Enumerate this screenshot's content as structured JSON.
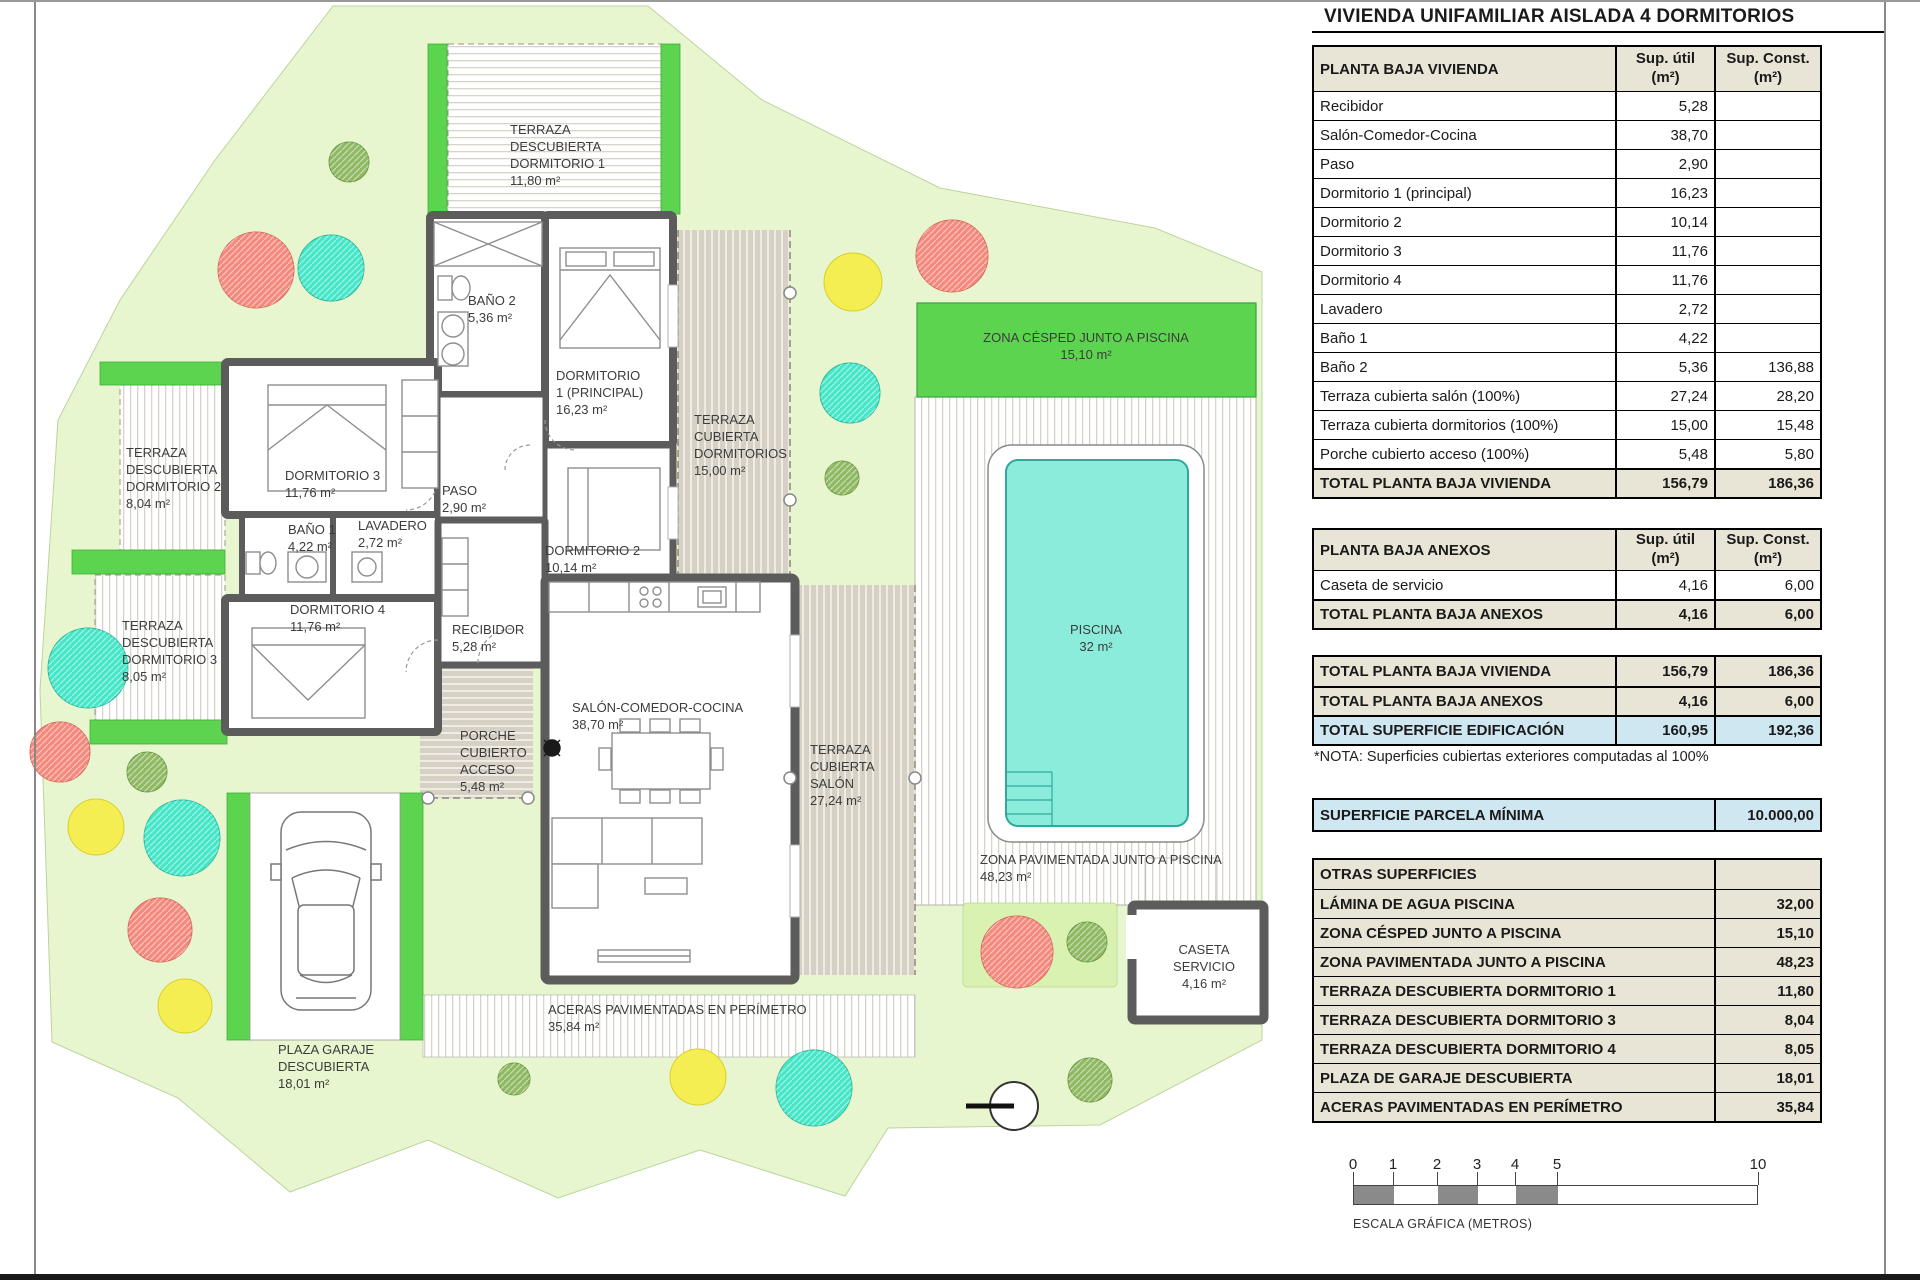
{
  "title": "VIVIENDA UNIFAMILIAR AISLADA 4 DORMITORIOS",
  "columns": {
    "util_lines": [
      "Sup. útil",
      "(m²)"
    ],
    "const_lines": [
      "Sup. Const.",
      "(m²)"
    ]
  },
  "vivienda": {
    "header": "PLANTA BAJA VIVIENDA",
    "rows": [
      {
        "label": "Recibidor",
        "util": "5,28",
        "const": ""
      },
      {
        "label": "Salón-Comedor-Cocina",
        "util": "38,70",
        "const": ""
      },
      {
        "label": "Paso",
        "util": "2,90",
        "const": ""
      },
      {
        "label": "Dormitorio 1 (principal)",
        "util": "16,23",
        "const": ""
      },
      {
        "label": "Dormitorio 2",
        "util": "10,14",
        "const": ""
      },
      {
        "label": "Dormitorio 3",
        "util": "11,76",
        "const": ""
      },
      {
        "label": "Dormitorio 4",
        "util": "11,76",
        "const": ""
      },
      {
        "label": "Lavadero",
        "util": "2,72",
        "const": ""
      },
      {
        "label": "Baño 1",
        "util": "4,22",
        "const": ""
      },
      {
        "label": "Baño 2",
        "util": "5,36",
        "const": "136,88"
      },
      {
        "label": "Terraza cubierta salón (100%)",
        "util": "27,24",
        "const": "28,20"
      },
      {
        "label": "Terraza cubierta dormitorios (100%)",
        "util": "15,00",
        "const": "15,48"
      },
      {
        "label": "Porche cubierto acceso (100%)",
        "util": "5,48",
        "const": "5,80"
      }
    ],
    "total": {
      "label": "TOTAL PLANTA BAJA VIVIENDA",
      "util": "156,79",
      "const": "186,36"
    }
  },
  "anexos": {
    "header": "PLANTA BAJA ANEXOS",
    "rows": [
      {
        "label": "Caseta de servicio",
        "util": "4,16",
        "const": "6,00"
      }
    ],
    "total": {
      "label": "TOTAL PLANTA BAJA ANEXOS",
      "util": "4,16",
      "const": "6,00"
    }
  },
  "resumen": {
    "rows": [
      {
        "label": "TOTAL PLANTA BAJA VIVIENDA",
        "util": "156,79",
        "const": "186,36"
      },
      {
        "label": "TOTAL PLANTA BAJA ANEXOS",
        "util": "4,16",
        "const": "6,00"
      },
      {
        "label": "TOTAL SUPERFICIE EDIFICACIÓN",
        "util": "160,95",
        "const": "192,36"
      }
    ]
  },
  "nota": "*NOTA: Superficies cubiertas exteriores computadas al 100%",
  "parcela": {
    "label": "SUPERFICIE PARCELA MÍNIMA",
    "value": "10.000,00"
  },
  "otras": {
    "header": "OTRAS SUPERFICIES",
    "rows": [
      {
        "label": "LÁMINA DE AGUA PISCINA",
        "value": "32,00"
      },
      {
        "label": "ZONA CÉSPED JUNTO A PISCINA",
        "value": "15,10"
      },
      {
        "label": "ZONA PAVIMENTADA JUNTO A PISCINA",
        "value": "48,23"
      },
      {
        "label": "TERRAZA DESCUBIERTA DORMITORIO 1",
        "value": "11,80"
      },
      {
        "label": "TERRAZA DESCUBIERTA DORMITORIO 3",
        "value": "8,04"
      },
      {
        "label": "TERRAZA DESCUBIERTA DORMITORIO 4",
        "value": "8,05"
      },
      {
        "label": "PLAZA DE GARAJE DESCUBIERTA",
        "value": "18,01"
      },
      {
        "label": "ACERAS PAVIMENTADAS EN PERÍMETRO",
        "value": "35,84"
      }
    ]
  },
  "plan_labels": {
    "terraza_d1": [
      "TERRAZA",
      "DESCUBIERTA",
      "DORMITORIO 1",
      "11,80 m²"
    ],
    "terraza_d2": [
      "TERRAZA",
      "DESCUBIERTA",
      "DORMITORIO 2",
      "8,04 m²"
    ],
    "terraza_d3": [
      "TERRAZA",
      "DESCUBIERTA",
      "DORMITORIO 3",
      "8,05 m²"
    ],
    "bano2": [
      "BAÑO 2",
      "5,36 m²"
    ],
    "dorm1": [
      "DORMITORIO",
      "1 (PRINCIPAL)",
      "16,23 m²"
    ],
    "dorm2": [
      "DORMITORIO 2",
      "10,14 m²"
    ],
    "dorm3": [
      "DORMITORIO 3",
      "11,76 m²"
    ],
    "dorm4": [
      "DORMITORIO 4",
      "11,76 m²"
    ],
    "paso": [
      "PASO",
      "2,90 m²"
    ],
    "bano1": [
      "BAÑO 1",
      "4,22 m²"
    ],
    "lavadero": [
      "LAVADERO",
      "2,72 m²"
    ],
    "recibidor": [
      "RECIBIDOR",
      "5,28 m²"
    ],
    "salon": [
      "SALÓN-COMEDOR-COCINA",
      "38,70 m²"
    ],
    "porche": [
      "PORCHE",
      "CUBIERTO",
      "ACCESO",
      "5,48 m²"
    ],
    "terr_cub_dorm": [
      "TERRAZA",
      "CUBIERTA",
      "DORMITORIOS",
      "15,00 m²"
    ],
    "terr_cub_salon": [
      "TERRAZA",
      "CUBIERTA",
      "SALÓN",
      "27,24 m²"
    ],
    "zona_cesped": [
      "ZONA CÉSPED JUNTO A PISCINA",
      "15,10 m²"
    ],
    "piscina": [
      "PISCINA",
      "32 m²"
    ],
    "zona_pav": [
      "ZONA PAVIMENTADA JUNTO A PISCINA",
      "48,23 m²"
    ],
    "caseta": [
      "CASETA",
      "SERVICIO",
      "4,16 m²"
    ],
    "aceras": [
      "ACERAS PAVIMENTADAS EN PERÍMETRO",
      "35,84 m²"
    ],
    "plaza_garaje": [
      "PLAZA GARAJE",
      "DESCUBIERTA",
      "18,01 m²"
    ]
  },
  "scale": {
    "ticks": [
      "0",
      "1",
      "2",
      "3",
      "4",
      "5",
      "10"
    ],
    "caption": "ESCALA GRÁFICA (METROS)"
  },
  "colors": {
    "parcel_green": "#e7f6cf",
    "hedge_green": "#5dd44f",
    "pool_water": "#8cecdc",
    "tree_teal": "#46e6c8",
    "tree_salmon": "#f28a7d",
    "tree_yellow": "#f5ee52",
    "tree_olive": "#90b963",
    "table_beige": "#e9e5d6",
    "table_blue": "#cfe7f1"
  }
}
